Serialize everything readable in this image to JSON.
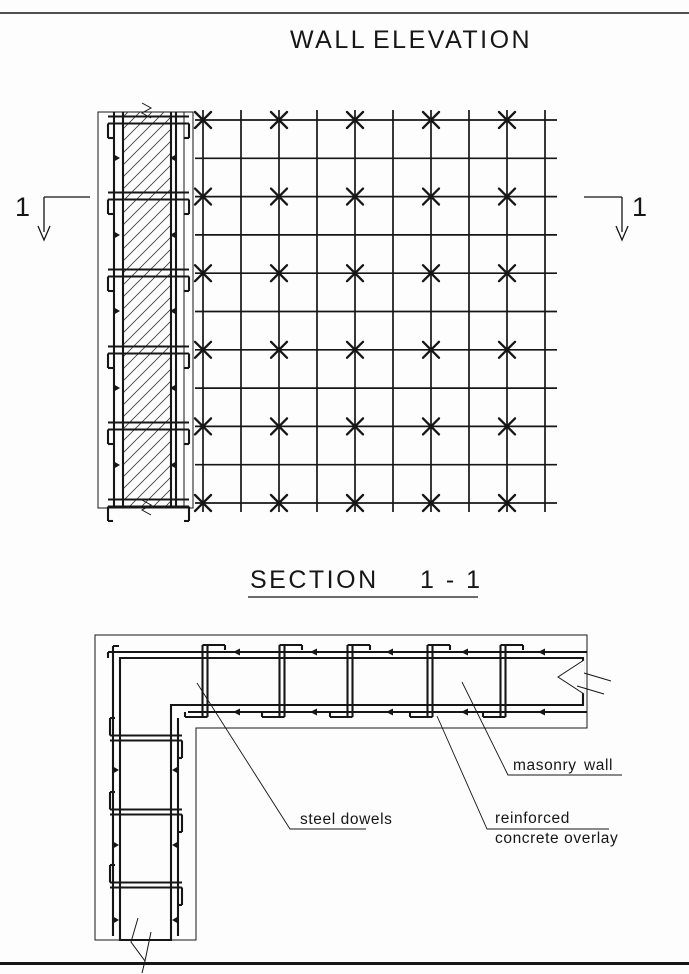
{
  "page": {
    "bg": "#fdfdfd",
    "ink": "#161616"
  },
  "elevation_view": {
    "title_word1": "WALL",
    "title_word2": "ELEVATION",
    "cut_marker_label_left": "1",
    "cut_marker_label_right": "1"
  },
  "section_view": {
    "title_word": "SECTION",
    "title_num": "1 - 1",
    "labels": {
      "steel_dowels": "steel dowels",
      "masonry_word1": "masonry",
      "masonry_word2": "wall",
      "overlay_line1": "reinforced",
      "overlay_line2": "concrete overlay"
    }
  },
  "drawing": {
    "grid": {
      "x0": 203,
      "dx": 38,
      "cols": 10,
      "yTop": 110,
      "yBot": 512,
      "y0": 120,
      "dy": 38.3,
      "rows": 11,
      "xLeft": 195,
      "xRight": 557
    },
    "xmarks": {
      "x0": 203,
      "dx": 76,
      "cols": 5,
      "y0": 120,
      "dy": 76.6,
      "rows": 6,
      "arm": 8
    },
    "strip": {
      "bandYs": [
        120,
        196,
        273,
        350,
        426,
        503
      ],
      "tickYs": [
        158,
        235,
        311,
        388,
        465
      ]
    },
    "section": {
      "dowelXs": [
        205,
        282,
        350,
        430,
        503
      ],
      "dowelYs": [
        738,
        812,
        885
      ],
      "tickXs": [
        240,
        317,
        393,
        468,
        545
      ],
      "tickYs": [
        770,
        845,
        920
      ]
    }
  }
}
